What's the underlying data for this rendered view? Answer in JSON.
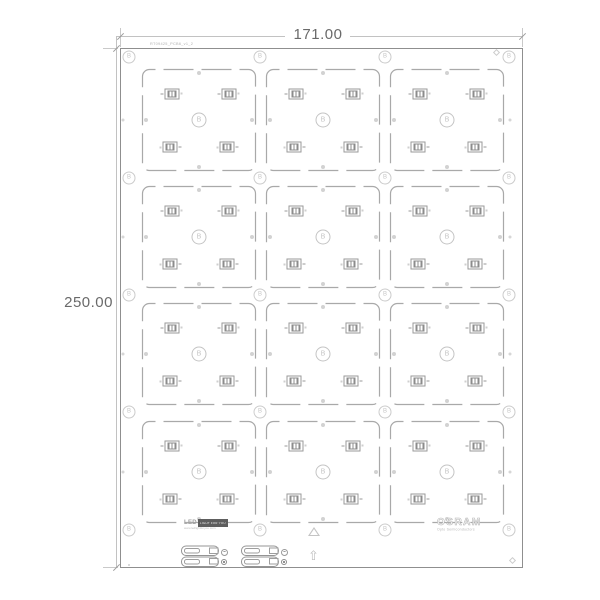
{
  "drawing": {
    "title": "pcb-panel-drawing",
    "dimensions": {
      "width_label": "171.00",
      "height_label": "250.00"
    },
    "annotations": {
      "part_number": "RT09425_PCB6_v1_2",
      "marker_letter": "B"
    },
    "brands": {
      "left_text": "LED",
      "left_block": "LIGHT FOR YOU",
      "left_sub": "www.ledlightforyou.com",
      "right_text": "OSRAM",
      "right_sub": "Opto Semiconductors"
    },
    "colors": {
      "background": "#ffffff",
      "panel_border": "#8f8f8f",
      "module_outline": "#a9a9a9",
      "dimension_line": "#c2c2c2",
      "dimension_text": "#6a6a6a",
      "marker": "#c6c6c6",
      "component": "#9a9a9a",
      "dot": "#d2d2d2"
    },
    "panel": {
      "x": 120,
      "y": 48,
      "w": 403,
      "h": 520,
      "marker_xs": [
        129,
        260,
        385,
        509
      ],
      "marker_ys": [
        57,
        178,
        295,
        412,
        530
      ],
      "module_cols": [
        141,
        265,
        389
      ],
      "module_rows": [
        68,
        185,
        302,
        420
      ],
      "module_w": 116,
      "module_h": 104,
      "led_positions": [
        {
          "x": 30,
          "y": 26,
          "rot": 0
        },
        {
          "x": 87,
          "y": 26,
          "rot": 0
        },
        {
          "x": 30,
          "y": 79,
          "rot": 1
        },
        {
          "x": 87,
          "y": 79,
          "rot": 1
        }
      ],
      "center_marker": {
        "x": 58,
        "y": 52
      },
      "edge_dots": [
        [
          58,
          5
        ],
        [
          58,
          99
        ],
        [
          5,
          52
        ],
        [
          111,
          52
        ]
      ],
      "rail_dot_xs": [
        123,
        510
      ],
      "rail_dot_ys": [
        120,
        237,
        354,
        472
      ]
    },
    "bottom": {
      "connector_xs": [
        181,
        241
      ],
      "connector_y": 545,
      "icon_xs": [
        221,
        281
      ],
      "icon_minus_y": 549,
      "icon_dot_y": 559
    }
  }
}
